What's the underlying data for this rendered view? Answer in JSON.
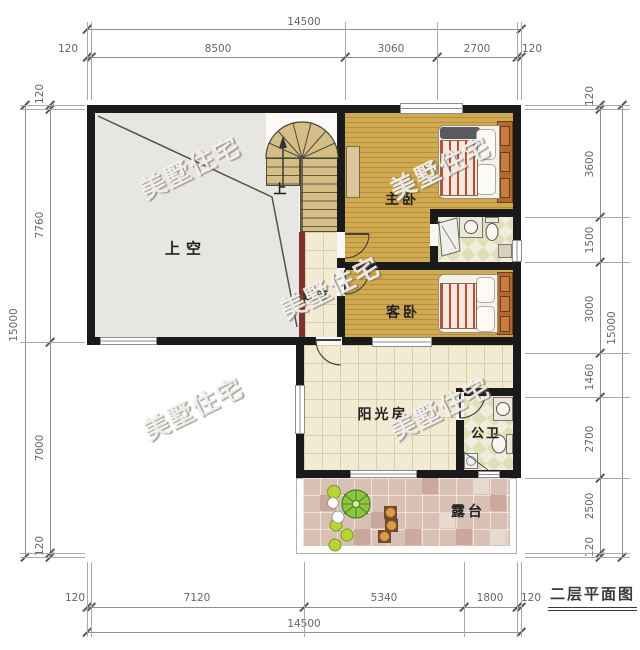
{
  "title": "二层平面图",
  "watermark": "美墅住宅",
  "labels": {
    "void": "上空",
    "master_bedroom": "主卧",
    "guest_bedroom": "客卧",
    "sunroom": "阳光房",
    "public_bath": "公卫",
    "terrace": "露台",
    "corridor": "过道",
    "stairs_up": "上"
  },
  "dimensions": {
    "top": {
      "total": "14500",
      "segments": [
        "120",
        "8500",
        "3060",
        "2700",
        "120"
      ]
    },
    "bottom": {
      "total": "14500",
      "segments": [
        "120",
        "7120",
        "5340",
        "1800",
        "120"
      ]
    },
    "left": {
      "total": "15000",
      "segments": [
        "120",
        "7760",
        "7000",
        "120"
      ]
    },
    "right": {
      "total": "15000",
      "segments": [
        "120",
        "3600",
        "1500",
        "3000",
        "1460",
        "2700",
        "2500",
        "120"
      ]
    }
  },
  "colors": {
    "wall": "#1a1a1a",
    "wood_floor": "#d0aa50",
    "tile_floor": "#f3ead3",
    "void_floor": "#e8e6e3",
    "terrace_tile": "#d9c0b5",
    "bath_tile": "#dce1ba",
    "stair_tread": "#d4be86",
    "stair_rail": "#7d342c",
    "blanket_stripe": "#c4483a",
    "dimension_text": "#666666"
  }
}
